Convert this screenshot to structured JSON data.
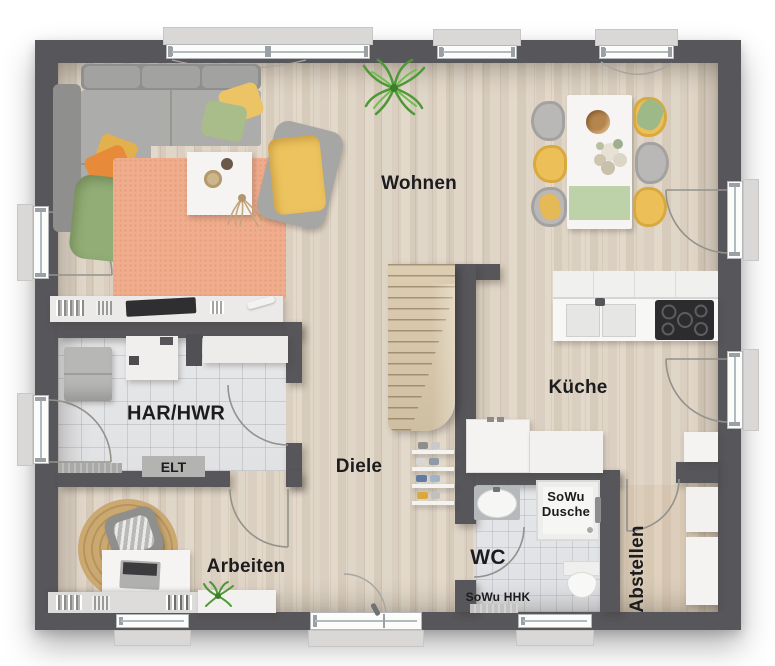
{
  "floorplan": {
    "rooms": {
      "wohnen": {
        "label": "Wohnen"
      },
      "kueche": {
        "label": "Küche"
      },
      "har_hwr": {
        "label": "HAR/HWR"
      },
      "diele": {
        "label": "Diele"
      },
      "arbeiten": {
        "label": "Arbeiten"
      },
      "wc": {
        "label": "WC"
      },
      "abstellen": {
        "label": "Abstellen"
      }
    },
    "annotations": {
      "elt": "ELT",
      "sowu_dusche_line1": "SoWu",
      "sowu_dusche_line2": "Dusche",
      "sowu_hhk": "SoWu HHK"
    },
    "colors": {
      "wall": "#57565a",
      "floor_wood": "#ddd2c2",
      "floor_tile": "#e4e5e7",
      "window_frame": "#fcfcfb",
      "sill": "#d9d8d6",
      "rug_living": "#efad8d",
      "rug_office": "#c5a36e",
      "stairs_wood": "#d5c5a9",
      "furniture_white": "#f5f4f2",
      "sofa_gray": "#a5a4a2",
      "accent_yellow": "#ecc05e",
      "accent_green": "#96af79",
      "accent_orange": "#e78a3a",
      "cooktop_black": "#2c2c2e",
      "label_text": "#1c1c1e"
    }
  }
}
